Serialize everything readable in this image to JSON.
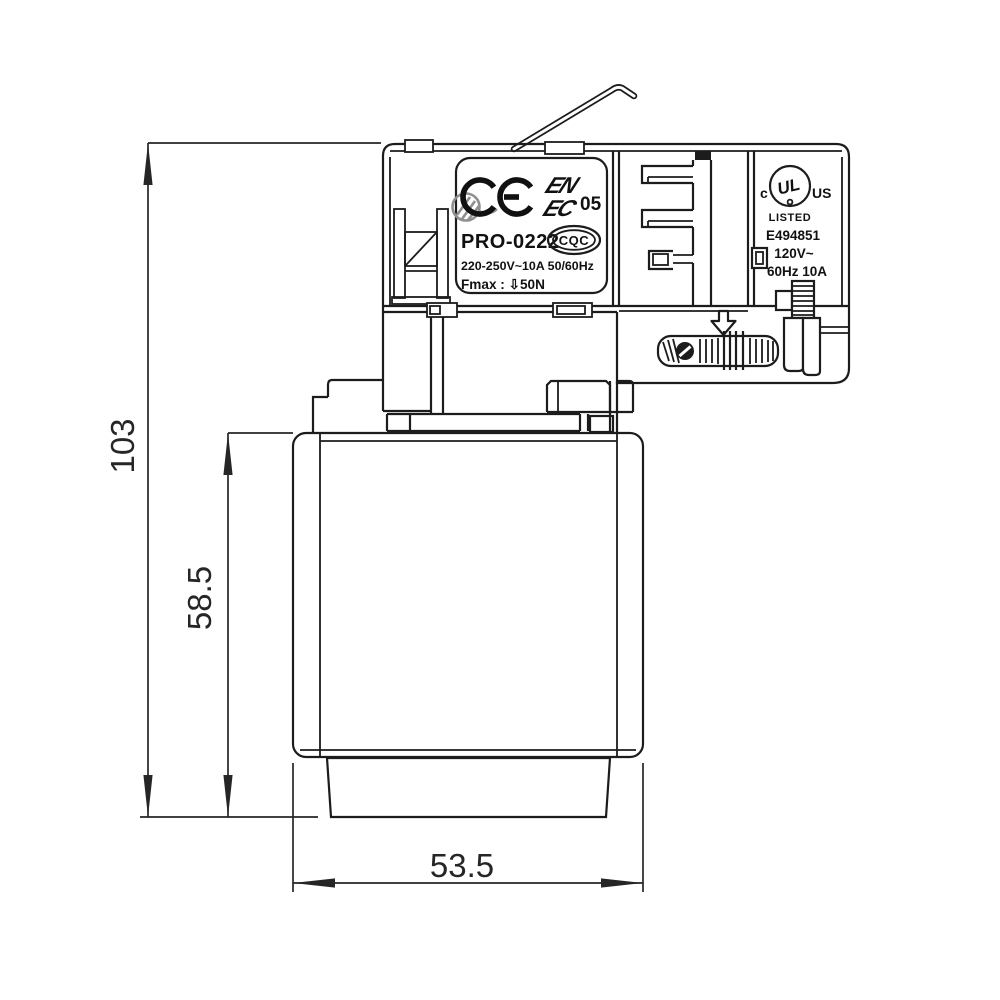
{
  "dimensions": {
    "overall_height": "103",
    "body_height": "58.5",
    "body_width": "53.5"
  },
  "label_plate": {
    "ce_mark": "CE",
    "enec_line1": "EN",
    "enec_line2": "EC",
    "enec_number": "05",
    "model": "PRO-0222",
    "rating": "220-250V~10A  50/60Hz",
    "fmax": "Fmax : ⇩50N",
    "cqc": "CQC"
  },
  "ul_label": {
    "c": "c",
    "ul": "UL",
    "us": "US",
    "listed": "LISTED",
    "file_number": "E494851",
    "voltage": "120V~",
    "frequency_current": "60Hz 10A"
  },
  "icons": {
    "watermark": "crossed-circle-watermark",
    "arrow": "hollow-down-arrow",
    "dial_screw": "slotted-screw"
  },
  "colors": {
    "line": "#1c1c1c",
    "background": "#ffffff",
    "watermark": "#8f8f8f"
  }
}
